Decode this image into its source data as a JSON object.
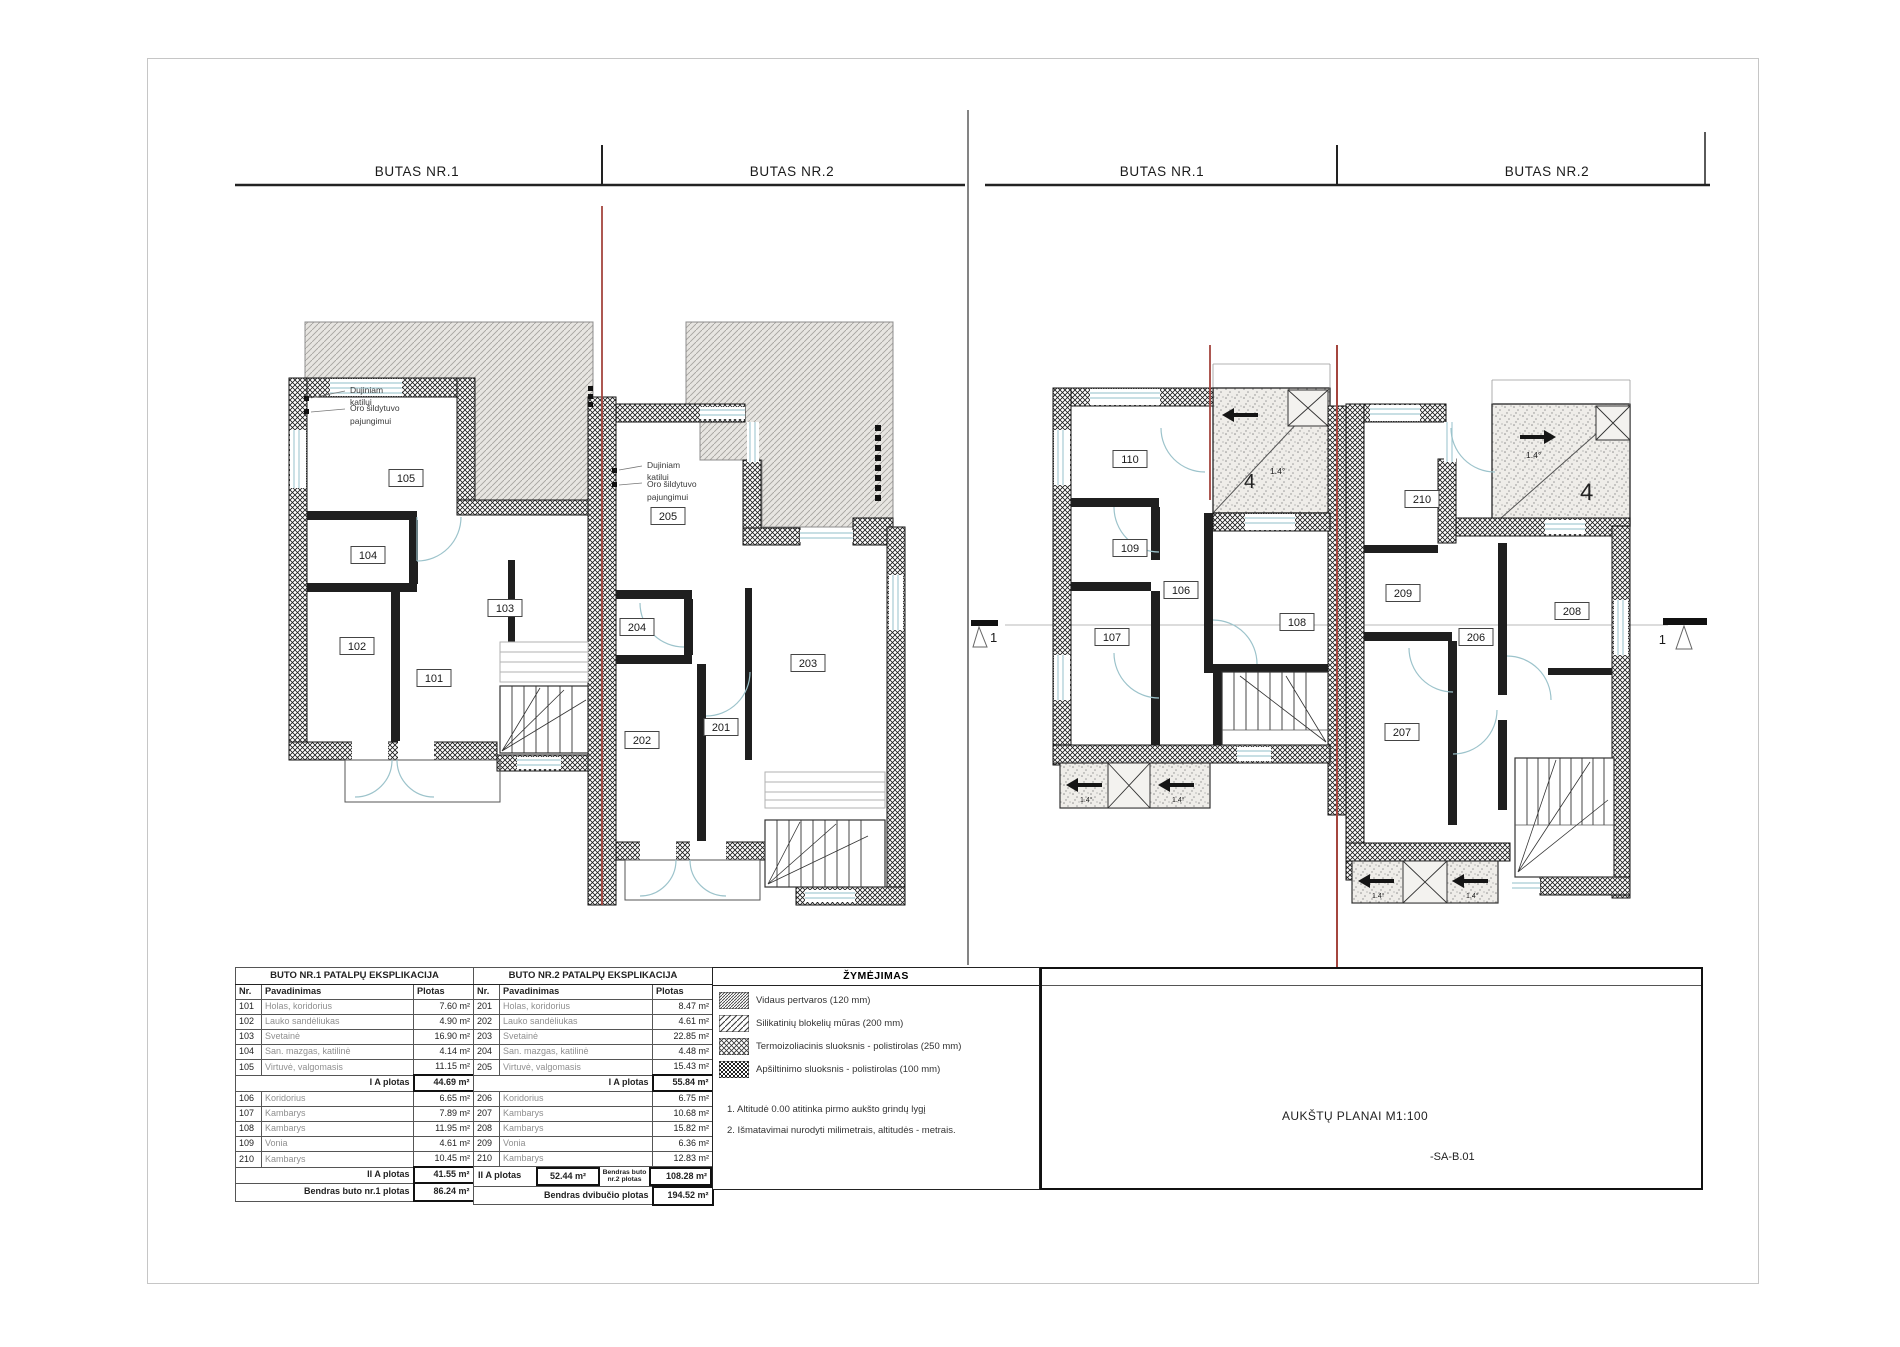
{
  "headers": {
    "f1_left": "BUTAS NR.1",
    "f1_right": "BUTAS NR.2",
    "f2_left": "BUTAS NR.1",
    "f2_right": "BUTAS NR.2"
  },
  "rooms": {
    "f1": {
      "101": "101",
      "102": "102",
      "103": "103",
      "104": "104",
      "105": "105",
      "201": "201",
      "202": "202",
      "203": "203",
      "204": "204",
      "205": "205"
    },
    "f2": {
      "106": "106",
      "107": "107",
      "108": "108",
      "109": "109",
      "110": "110",
      "206": "206",
      "207": "207",
      "208": "208",
      "209": "209",
      "210": "210"
    }
  },
  "annotation": {
    "l1": "Dujiniam",
    "l2": "katilui",
    "l3": "Oro šildytuvo",
    "l4": "pajungimui"
  },
  "marks": {
    "section": "1",
    "slope": "1.4°",
    "roof": "4"
  },
  "tables": {
    "left": {
      "title": "BUTO NR.1 PATALPŲ EKSPLIKACIJA",
      "columns": {
        "nr": "Nr.",
        "name": "Pavadinimas",
        "area": "Plotas"
      },
      "floor1_rows": [
        {
          "nr": "101",
          "name": "Holas, koridorius",
          "area": "7.60 m²"
        },
        {
          "nr": "102",
          "name": "Lauko sandėliukas",
          "area": "4.90 m²"
        },
        {
          "nr": "103",
          "name": "Svetainė",
          "area": "16.90 m²"
        },
        {
          "nr": "104",
          "name": "San. mazgas, katilinė",
          "area": "4.14 m²"
        },
        {
          "nr": "105",
          "name": "Virtuvė, valgomasis",
          "area": "11.15 m²"
        }
      ],
      "sum1_label": "I A plotas",
      "sum1_value": "44.69 m²",
      "floor2_rows": [
        {
          "nr": "106",
          "name": "Koridorius",
          "area": "6.65 m²"
        },
        {
          "nr": "107",
          "name": "Kambarys",
          "area": "7.89 m²"
        },
        {
          "nr": "108",
          "name": "Kambarys",
          "area": "11.95 m²"
        },
        {
          "nr": "109",
          "name": "Vonia",
          "area": "4.61 m²"
        },
        {
          "nr": "210",
          "name": "Kambarys",
          "area": "10.45 m²"
        }
      ],
      "sum2_label": "II A plotas",
      "sum2_value": "41.55 m²",
      "total_label": "Bendras buto nr.1 plotas",
      "total_value": "86.24 m²"
    },
    "right": {
      "title": "BUTO NR.2 PATALPŲ EKSPLIKACIJA",
      "columns": {
        "nr": "Nr.",
        "name": "Pavadinimas",
        "area": "Plotas"
      },
      "floor1_rows": [
        {
          "nr": "201",
          "name": "Holas, koridorius",
          "area": "8.47 m²"
        },
        {
          "nr": "202",
          "name": "Lauko sandėliukas",
          "area": "4.61 m²"
        },
        {
          "nr": "203",
          "name": "Svetainė",
          "area": "22.85 m²"
        },
        {
          "nr": "204",
          "name": "San. mazgas, katilinė",
          "area": "4.48 m²"
        },
        {
          "nr": "205",
          "name": "Virtuvė, valgomasis",
          "area": "15.43 m²"
        }
      ],
      "sum1_label": "I A plotas",
      "sum1_value": "55.84 m²",
      "floor2_rows": [
        {
          "nr": "206",
          "name": "Koridorius",
          "area": "6.75 m²"
        },
        {
          "nr": "207",
          "name": "Kambarys",
          "area": "10.68 m²"
        },
        {
          "nr": "208",
          "name": "Kambarys",
          "area": "15.82 m²"
        },
        {
          "nr": "209",
          "name": "Vonia",
          "area": "6.36 m²"
        },
        {
          "nr": "210",
          "name": "Kambarys",
          "area": "12.83 m²"
        }
      ],
      "sum2_label": "II A plotas",
      "sum2_value": "52.44 m²",
      "total2_label": "Bendras buto nr.2 plotas",
      "total2_value": "108.28 m²",
      "grand_label": "Bendras dvibučio plotas",
      "grand_value": "194.52 m²"
    }
  },
  "legend": {
    "title": "ŽYMĖJIMAS",
    "items": [
      {
        "name": "partition-hatch",
        "label": "Vidaus pertvaros (120 mm)"
      },
      {
        "name": "masonry-hatch",
        "label": "Silikatinių blokelių mūras (200 mm)"
      },
      {
        "name": "thermal-hatch",
        "label": "Termoizoliacinis sluoksnis - polistirolas  (250 mm)"
      },
      {
        "name": "insulation-hatch",
        "label": "Apšiltinimo sluoksnis - polistirolas  (100 mm)"
      }
    ],
    "notes": [
      "1. Altitudė  0.00 atitinka pirmo aukšto grindų lygį",
      "2. Išmatavimai nurodyti milimetrais, altitudės - metrais."
    ]
  },
  "title_block": {
    "title": "AUKŠTŲ PLANAI M1:100",
    "code": "-SA-B.01"
  }
}
